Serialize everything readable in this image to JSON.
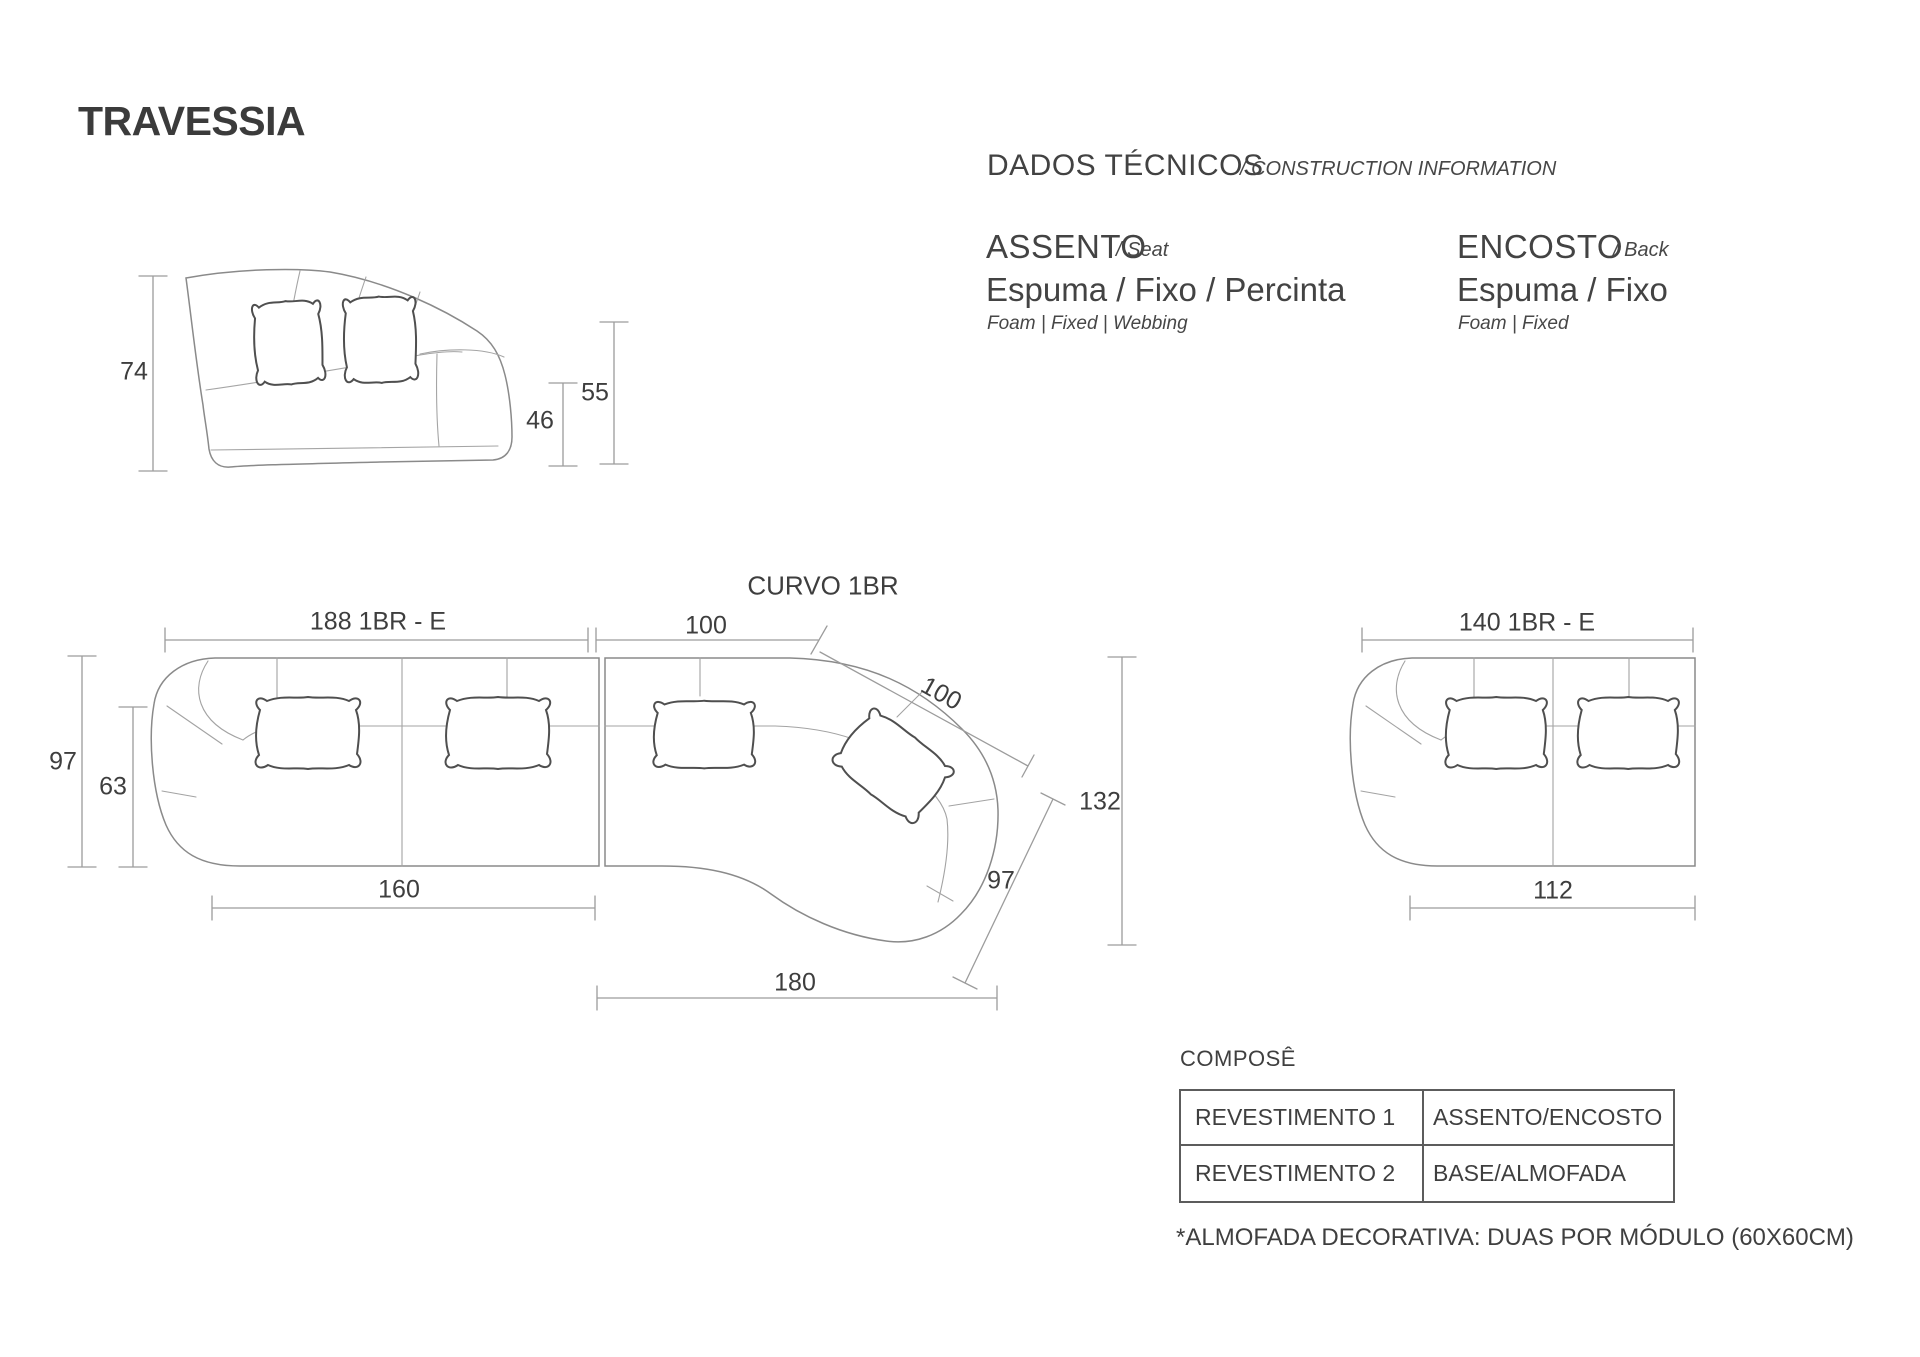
{
  "title": "TRAVESSIA",
  "colors": {
    "text": "#3e3e3e",
    "drawing_line": "#8f8f8f",
    "dimension_line": "#9c9c9c",
    "table_border": "#5c5c5c",
    "background": "#ffffff"
  },
  "tech_info": {
    "heading": "DADOS TÉCNICOS",
    "heading_translation": "/ CONSTRUCTION INFORMATION",
    "seat": {
      "label": "ASSENTO",
      "translation": "/ Seat",
      "materials": "Espuma / Fixo / Percinta",
      "materials_translation": "Foam | Fixed | Webbing"
    },
    "back": {
      "label": "ENCOSTO",
      "translation": "/ Back",
      "materials": "Espuma / Fixo",
      "materials_translation": "Foam | Fixed"
    }
  },
  "side_view": {
    "dims": {
      "total_height": "74",
      "seat_height": "46",
      "arm_height": "55"
    }
  },
  "plan_modules": [
    {
      "label": "188 1BR - E",
      "dims": {
        "depth": "97",
        "inner_depth": "63",
        "seat_width": "160"
      }
    },
    {
      "label": "CURVO 1BR",
      "dims": {
        "top_width": "100",
        "back_width": "100",
        "total_depth": "132",
        "side_depth": "97",
        "bottom_width": "180"
      }
    },
    {
      "label": "140 1BR - E",
      "dims": {
        "seat_width": "112"
      }
    }
  ],
  "compose_table": {
    "heading": "COMPOSÊ",
    "rows": [
      {
        "col1": "REVESTIMENTO 1",
        "col2": "ASSENTO/ENCOSTO"
      },
      {
        "col1": "REVESTIMENTO 2",
        "col2": "BASE/ALMOFADA"
      }
    ]
  },
  "footnote": "*ALMOFADA DECORATIVA: DUAS POR MÓDULO (60X60CM)"
}
